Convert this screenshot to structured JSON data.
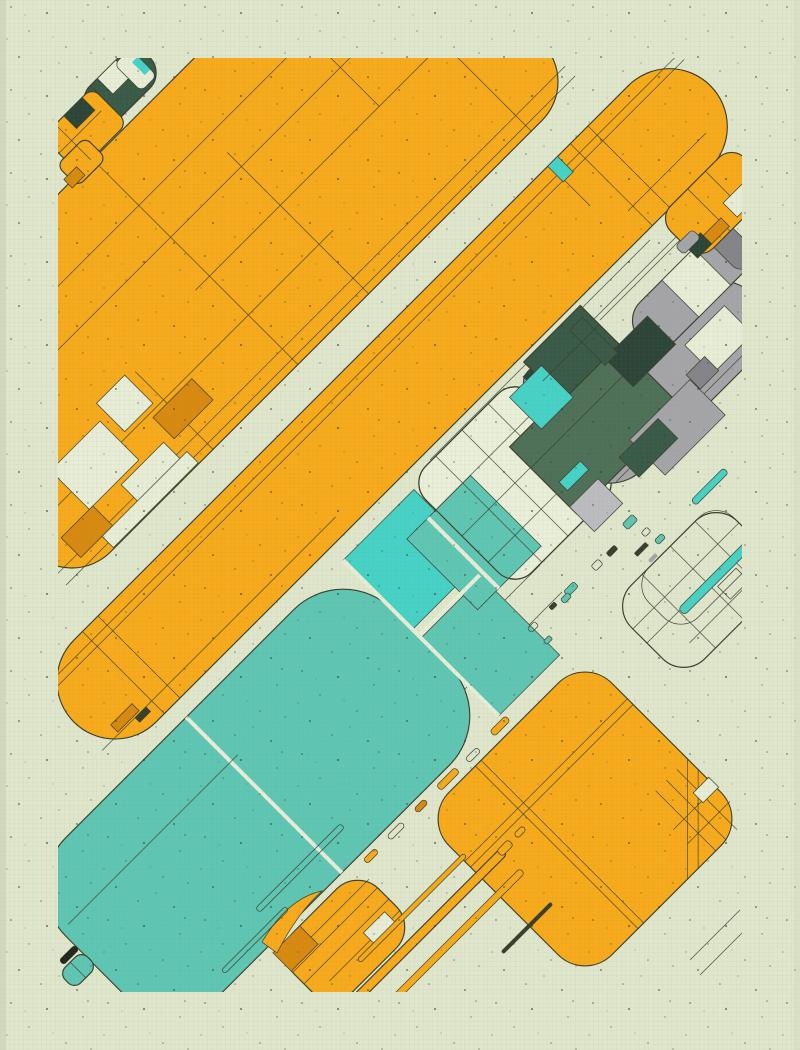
{
  "artwork": {
    "title": "abstract-diagonal-composition",
    "canvas": {
      "width": 800,
      "height": 1050
    },
    "style": "flat geometric 45-degree shapes on gridded speckled paper",
    "palette": {
      "bg": "#dfe6cc",
      "ink": "#3a3e2c",
      "dark": "#23281e",
      "orange": "#f7aa1b",
      "orange_deep": "#d8890f",
      "cream": "#e7edd6",
      "cream_light": "#e9efd8",
      "teal": "#5fc6b4",
      "teal_bright": "#46d2c6",
      "gray": "#a5a5a9",
      "gray_light": "#bcbcc0",
      "gray_dark": "#84848a",
      "green": "#4f7058",
      "green_deep": "#3a5a48",
      "green_dark": "#2d4538"
    },
    "texture": {
      "grid_size": "4.6",
      "grid_color": "#76855a",
      "speckle_color": "#2e3424"
    },
    "regions": [
      "orange-mass-top-left",
      "orange-band-diagonal",
      "center-outlined-diamond",
      "teal-band-bottom-left",
      "gray-pills-right",
      "dark-green-cluster",
      "orange-blob-right",
      "outlined-blob-right",
      "orange-diamond-bottom-right",
      "orange-cluster-bottom-center",
      "confetti-streets",
      "corner-miniatures"
    ]
  }
}
